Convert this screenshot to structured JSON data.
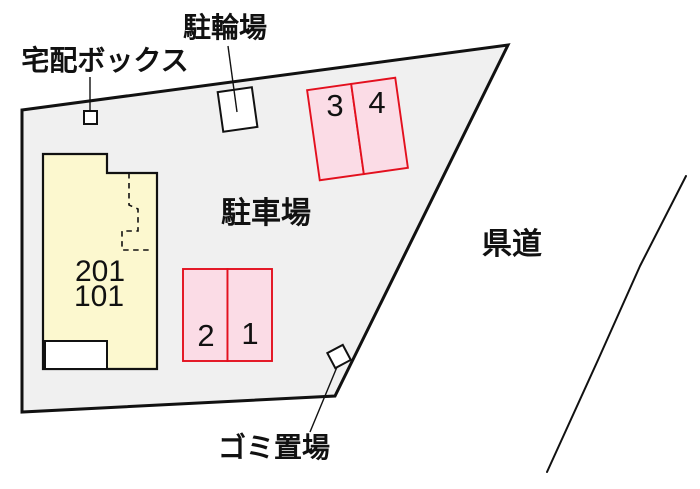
{
  "diagram": {
    "type": "property-site-plan",
    "labels": {
      "delivery_box": "宅配ボックス",
      "bicycle_parking": "駐輪場",
      "parking_lot": "駐車場",
      "prefectural_road": "県道",
      "garbage_area": "ゴミ置場"
    },
    "building": {
      "units": [
        "201",
        "101"
      ]
    },
    "parking_spaces": [
      "1",
      "2",
      "3",
      "4"
    ],
    "colors": {
      "site_fill": "#f0f0f0",
      "building_fill": "#fcf8cf",
      "parking_fill": "#fbdce6",
      "parking_border": "#e3101e",
      "outline": "#111111",
      "background": "#ffffff"
    }
  }
}
